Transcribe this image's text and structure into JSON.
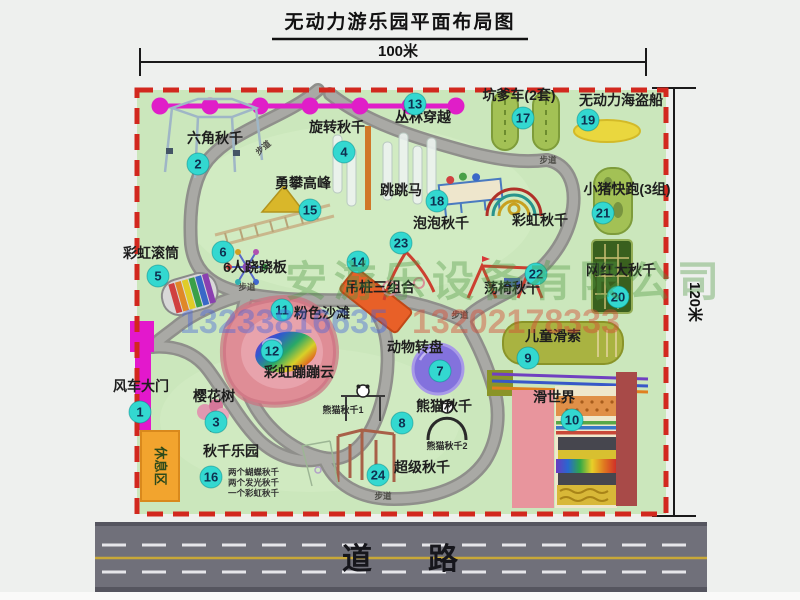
{
  "title": "无动力游乐园平面布局图",
  "dimensions": {
    "top": "100米",
    "right": "120米"
  },
  "road_label": "道路",
  "trail_label": "步道",
  "watermark": {
    "company": "安游乐设备有限公司",
    "phone1": "13233816635",
    "phone2": "13202178333"
  },
  "colors": {
    "grass": "#cbe7bc",
    "border_dashed": "#d2281e",
    "path": "#8f8f8b",
    "badge": "#33d8d0",
    "chain": "#e01ec8",
    "gate": "#e318cc",
    "road": "#70707a",
    "rest_area": "#f2a42e"
  },
  "items": [
    {
      "num": "1",
      "label": "风车大门"
    },
    {
      "num": "2",
      "label": "六角秋千"
    },
    {
      "num": "3",
      "label": "樱花树"
    },
    {
      "num": "4",
      "label": "旋转秋千"
    },
    {
      "num": "5",
      "label": "彩虹滚筒"
    },
    {
      "num": "6",
      "label": "6人跷跷板"
    },
    {
      "num": "7",
      "label": "动物转盘"
    },
    {
      "num": "8",
      "label": "熊猫秋千"
    },
    {
      "num": "9",
      "label": "儿童滑索"
    },
    {
      "num": "10",
      "label": "滑世界"
    },
    {
      "num": "11",
      "label": "粉色沙滩"
    },
    {
      "num": "12",
      "label": "彩虹蹦蹦云"
    },
    {
      "num": "13",
      "label": "丛林穿越"
    },
    {
      "num": "14",
      "label": "吊桩三组合"
    },
    {
      "num": "15",
      "label": "勇攀高峰"
    },
    {
      "num": "16",
      "label": "秋千乐园"
    },
    {
      "num": "17",
      "label": "坑爹车(2套)"
    },
    {
      "num": "18",
      "label": "跳跳马"
    },
    {
      "num": "19",
      "label": "无动力海盗船"
    },
    {
      "num": "20",
      "label": "网红大秋千"
    },
    {
      "num": "21",
      "label": "小猪快跑(3组)"
    },
    {
      "num": "22",
      "label": "荡椅秋千"
    },
    {
      "num": "23",
      "label": "泡泡秋千"
    },
    {
      "num": "24",
      "label": "超级秋千"
    }
  ],
  "extra_labels": {
    "rainbow_swing": "彩虹秋千",
    "panda_swing_1": "熊猫秋千1",
    "panda_swing_2": "熊猫秋千2",
    "rest_area": "休息区",
    "swing_park_notes": [
      "两个蝴蝶秋千",
      "两个发光秋千",
      "一个彩虹秋千"
    ]
  }
}
